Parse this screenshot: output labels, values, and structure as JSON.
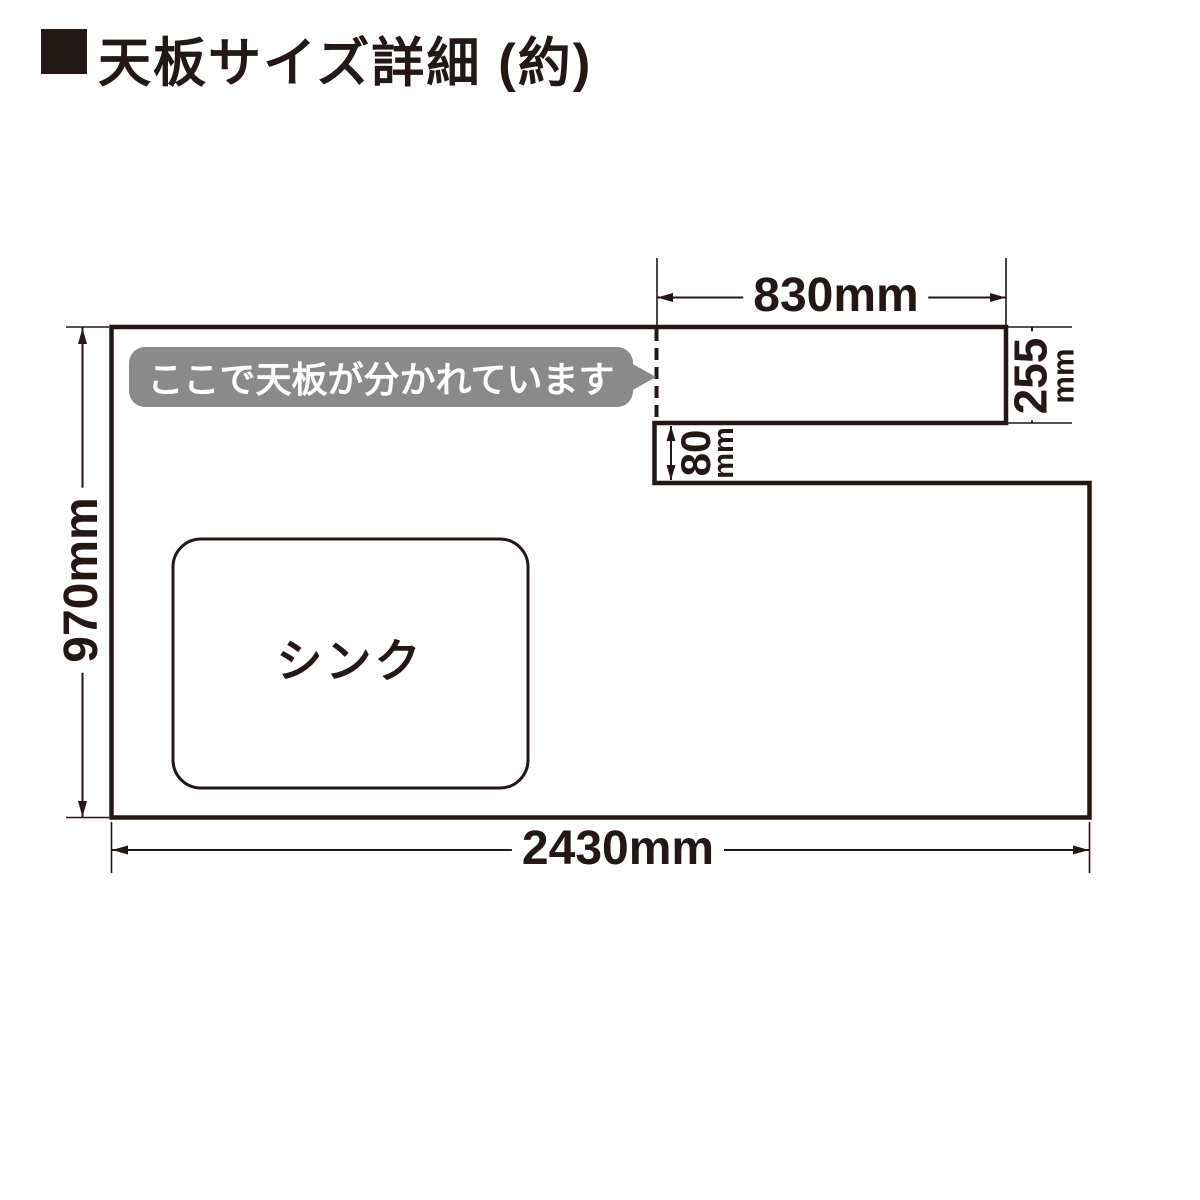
{
  "title": {
    "text": "天板サイズ詳細 (約)"
  },
  "icons": {
    "title_bullet": "black-square"
  },
  "callout": {
    "text": "ここで天板が分かれています"
  },
  "sink": {
    "label": "シンク"
  },
  "dimensions": {
    "top_section_width": {
      "label": "830mm",
      "value": "830",
      "unit": "mm"
    },
    "top_section_depth": {
      "value": "255",
      "unit": "mm"
    },
    "step_depth": {
      "value": "80",
      "unit": "mm"
    },
    "left_depth": {
      "label": "970mm",
      "value": "970",
      "unit": "mm"
    },
    "total_width": {
      "label": "2430mm",
      "value": "2430",
      "unit": "mm"
    }
  },
  "colors": {
    "line": "#231815",
    "callout_bg": "#8a8a8a",
    "callout_text": "#ffffff",
    "background": "#ffffff"
  }
}
